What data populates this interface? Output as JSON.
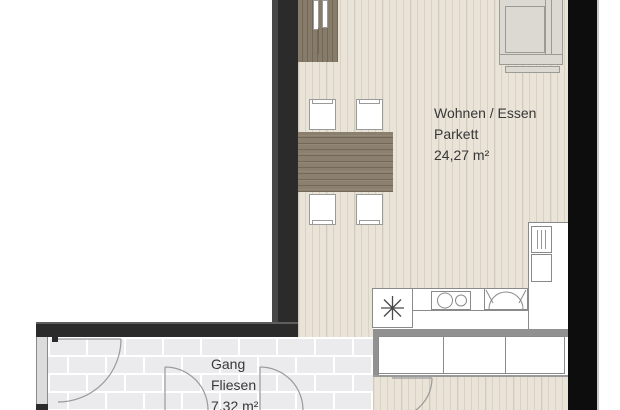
{
  "plan": {
    "rooms": {
      "living": {
        "name": "Wohnen / Essen",
        "floor_type": "Parkett",
        "area": "24,27 m²"
      },
      "hallway": {
        "name": "Gang",
        "floor_type": "Fliesen",
        "area": "7,32 m²"
      }
    },
    "colors": {
      "wall": "#2b2b2b",
      "wall_right": "#0d0d0d",
      "parquet": "#e9e3d8",
      "tiles": "#ebebee",
      "furniture_wood": "#8b7f6e",
      "sofa": "#dcd9d3",
      "outline": "#8a8a8a",
      "text": "#383838"
    },
    "icons": {
      "appliance_star": "8-spoke asterisk"
    }
  }
}
